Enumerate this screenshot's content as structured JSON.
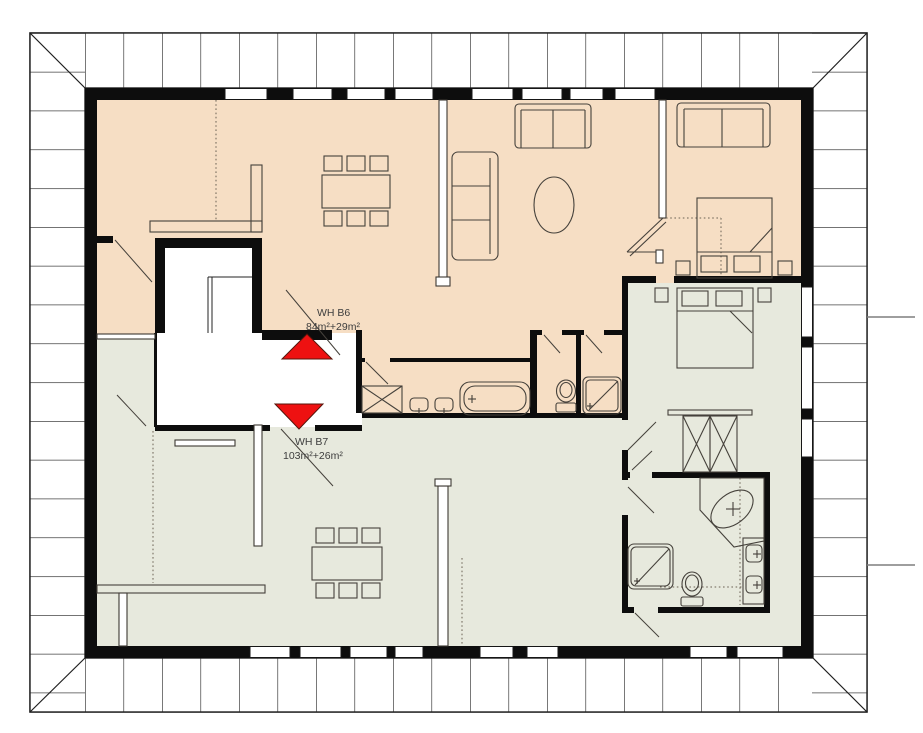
{
  "floor_plan": {
    "units": [
      {
        "name": "WH B6",
        "area": "84m²+29m²",
        "fill": "#f6dec4"
      },
      {
        "name": "WH B7",
        "area": "103m²+26m²",
        "fill": "#e7e9dd"
      }
    ],
    "stair_arrow": {
      "fill": "#ee1111",
      "outline": "#55150b"
    },
    "palette": {
      "wall": "#0d0d0d",
      "roof_tile_fill": "#ffffff",
      "roof_tile_line": "#1f1f1f",
      "furniture_line": "#45413b",
      "leader_line": "#7f7f7f",
      "background": "#ffffff"
    }
  }
}
